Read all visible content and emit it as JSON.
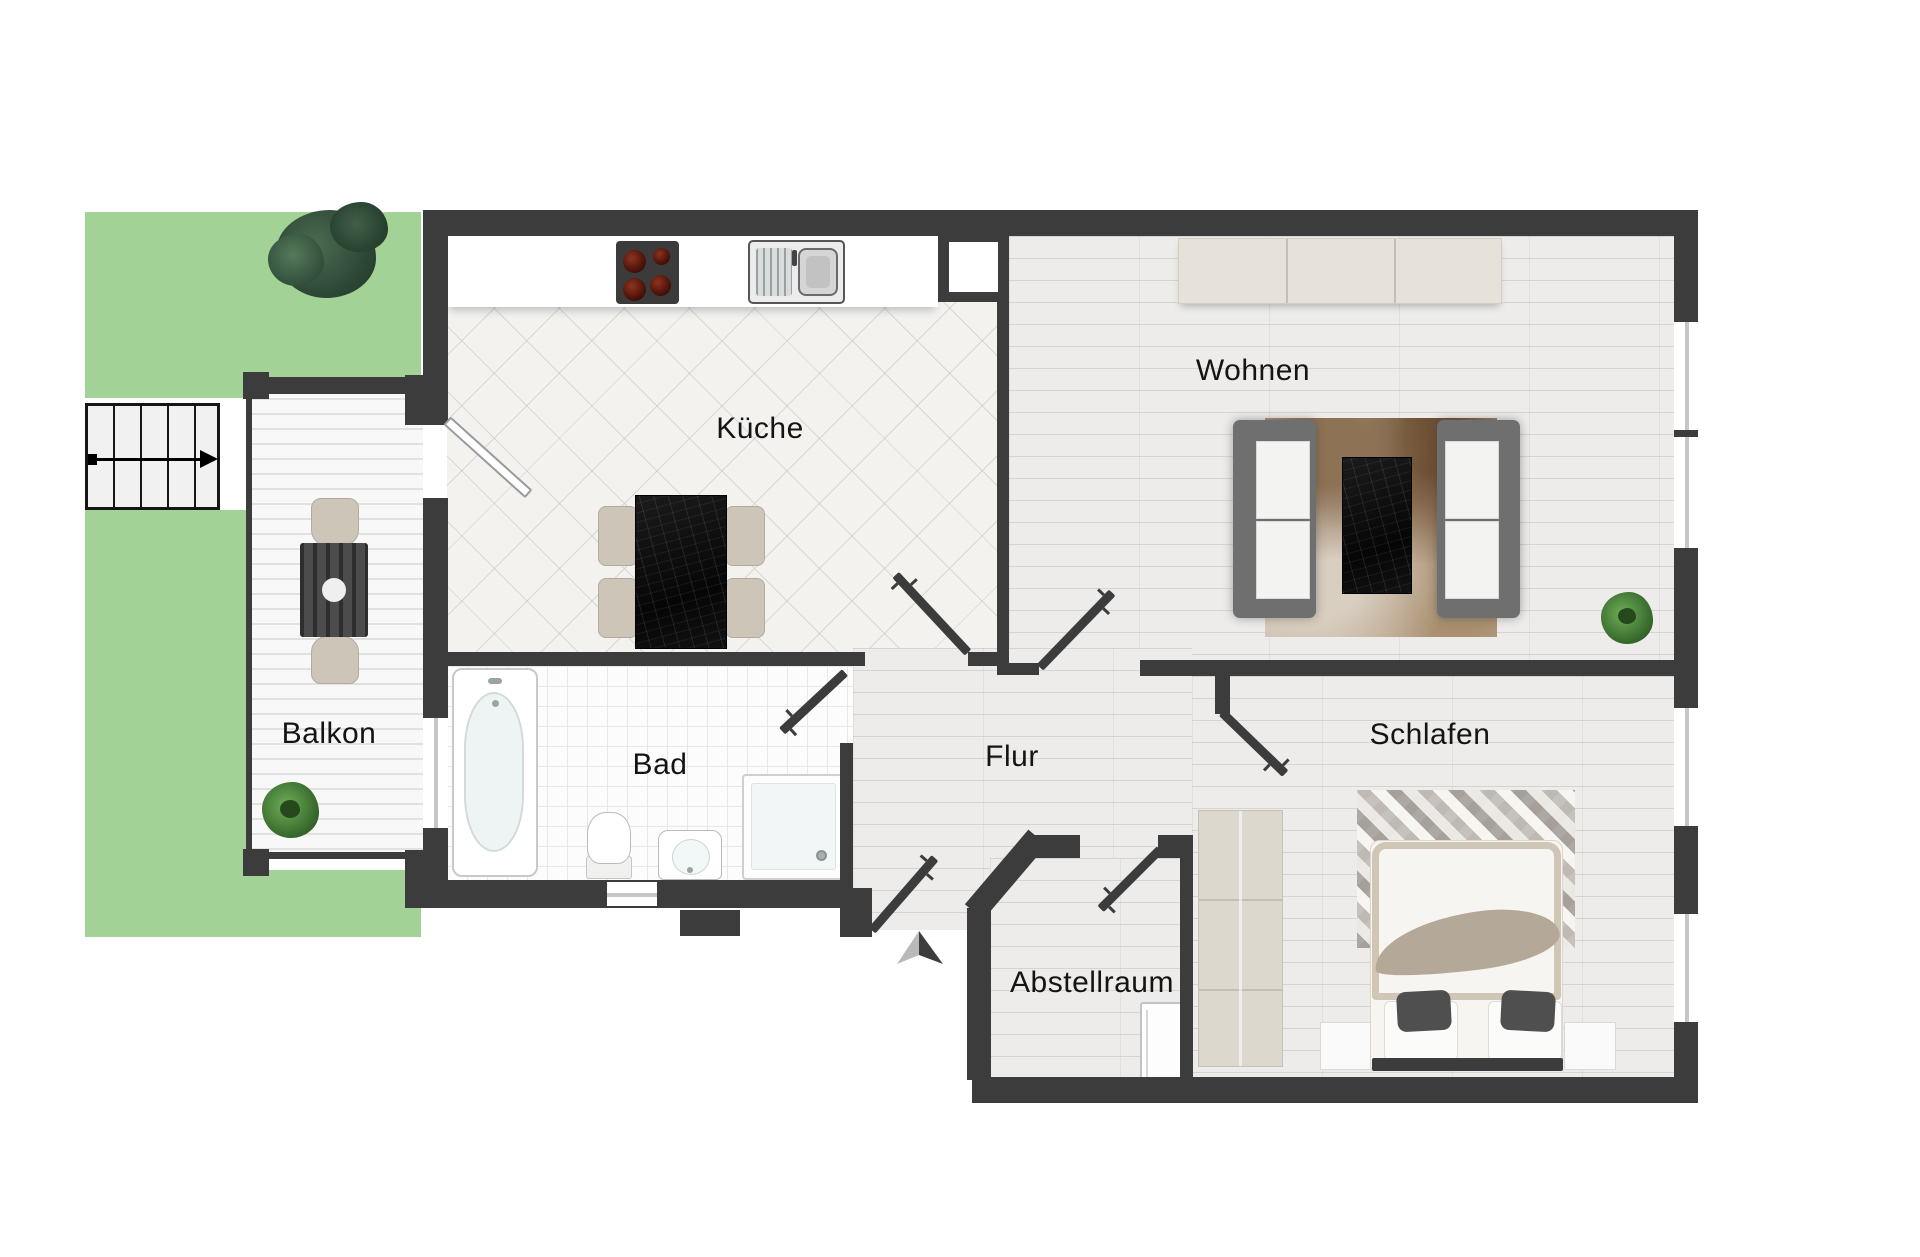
{
  "plan_title": "Apartment floor plan",
  "rooms": {
    "kitchen": {
      "label": "Küche"
    },
    "living": {
      "label": "Wohnen"
    },
    "balcony": {
      "label": "Balkon"
    },
    "bath": {
      "label": "Bad"
    },
    "hall": {
      "label": "Flur"
    },
    "bedroom": {
      "label": "Schlafen"
    },
    "storage": {
      "label": "Abstellraum"
    }
  },
  "icons": {
    "entrance_arrow": "entrance-direction-arrow",
    "stairs_arrow": "stairs-direction-arrow"
  },
  "theme": {
    "wall": "#3c3c3c",
    "door": "#3c3c3c",
    "garden": "#a3d297",
    "plank": "#edecea",
    "tile": "#f3f2ef",
    "bath": "#fcfcfc",
    "deck": "#f8f8f8",
    "beige": "#cdc5b7",
    "label": "#141414",
    "burner_red": "#7a2315"
  }
}
